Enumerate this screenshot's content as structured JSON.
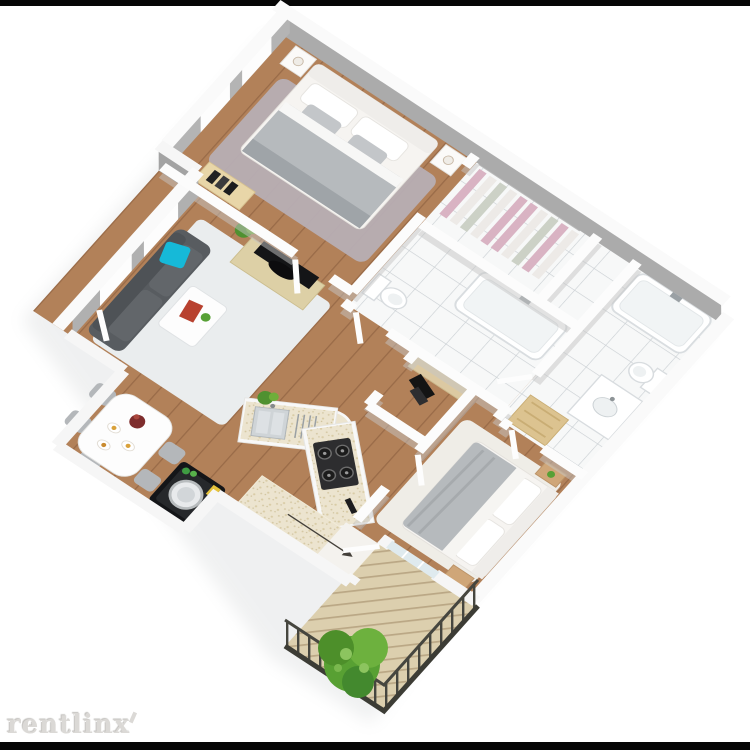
{
  "watermark": {
    "brand": "rentlinx"
  },
  "frame": {
    "background": "#ffffff",
    "top_bar_color": "#060606",
    "bottom_bar_color": "#060606"
  },
  "palette": {
    "wall_face_far": "#ababab",
    "wall_face_left": "#b4b4b4",
    "wall_top": "#fbfbfb",
    "wood_floor": "#b28159",
    "tile_floor": "#f7f8f8",
    "deck": "#dccfae",
    "railing": "#46463f",
    "sofa": "#585c60",
    "accent_pillow": "#16b9d8",
    "rug_master": "#b7aeb4",
    "rug_white": "#eaedee",
    "rug_bedroom2": "#efede7",
    "counter": "#ece4cf",
    "clothes_pink": "#d9b3c3",
    "plant_green": "#58a033",
    "stove": "#2d2d2f",
    "washer": "#141518",
    "bed_blanket": "#b6babd",
    "tv_console_wood": "#ddd0a6",
    "nightstand_wood": "#cfa678",
    "bench_wood": "#dcc390"
  }
}
